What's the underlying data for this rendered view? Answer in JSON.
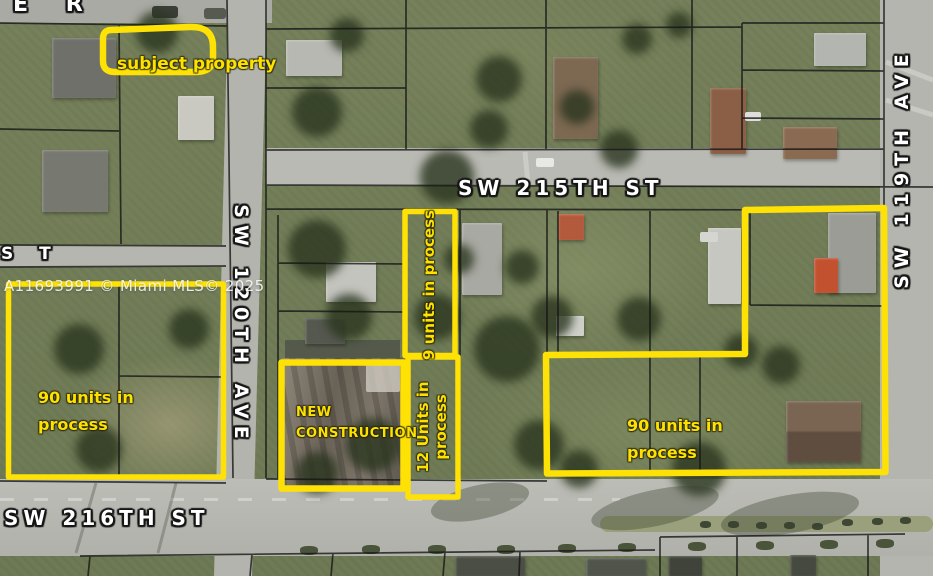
{
  "map": {
    "watermark": "A11693991 © Miami MLS© 2025",
    "street_labels": {
      "sw_215th_st": "SW 215TH ST",
      "sw_216th_st": "SW 216TH ST",
      "sw_120th_ave": "SW 120TH AVE",
      "sw_119th_ave": "SW 119TH AVE",
      "top_edge_fragment": "E R",
      "left_edge_fragment": "S T"
    },
    "annotations": {
      "subject_property": {
        "label": "subject property"
      },
      "left_block_90_units": {
        "line1": "90 units in",
        "line2": "process"
      },
      "nine_units": {
        "label": "9 units in process"
      },
      "twelve_units": {
        "line1": "12 Units in",
        "line2": "process"
      },
      "new_construction": {
        "line1": "NEW",
        "line2": "CONSTRUCTION"
      },
      "right_block_90_units": {
        "line1": "90 units in",
        "line2": "process"
      }
    },
    "colors": {
      "annotation_yellow": "#FFE205",
      "annotation_text_yellow": "#FFE100",
      "street_label_white": "#FFFFFF"
    }
  }
}
